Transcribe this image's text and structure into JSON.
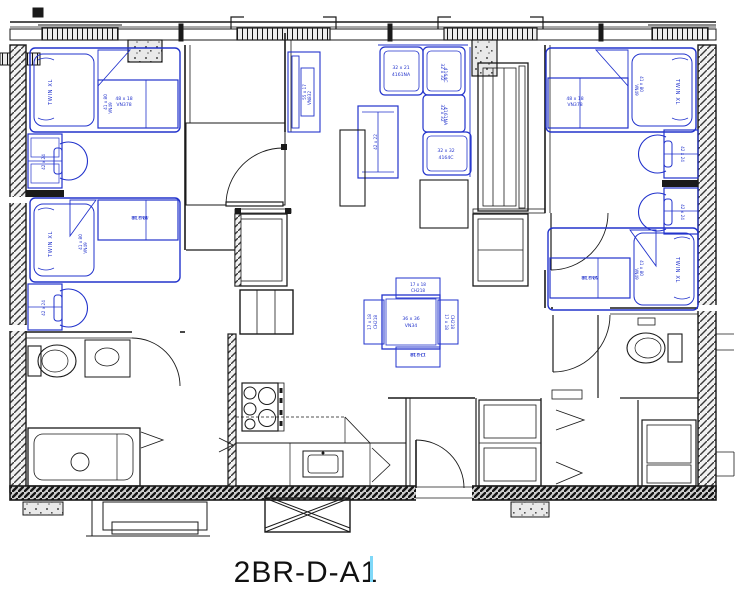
{
  "plan": {
    "title": "2BR-D-A1"
  },
  "furniture": {
    "bed": {
      "name": "TWIN XL",
      "dim": "41 x 80",
      "sku": "VN49"
    },
    "chest": {
      "dim": "48 x 18",
      "sku": "VN378"
    },
    "desk": {
      "dim": "42 x 24"
    },
    "tv_console": {
      "dim": "55 x 17",
      "sku": "VN832"
    },
    "coffee_table": {
      "dim": "42 x 22"
    },
    "dining_table": {
      "dim": "36 x 36",
      "sku": "VN34"
    },
    "dining_chair": {
      "dim": "17 x 18",
      "sku": "CH218"
    },
    "sofa_corner": {
      "dim": "32 x 21",
      "sku": "4161NA"
    },
    "sofa_seat1": {
      "dim": "32 x 32",
      "sku": "4164C"
    },
    "sofa_seat2": {
      "dim": "32 x 32",
      "sku": "4161NA"
    },
    "sofa_seat3": {
      "dim": "32 x 32",
      "sku": "4164C"
    }
  },
  "colors": {
    "furniture_blue": "#2233cc",
    "wall_black": "#1a1a1a",
    "caret_cyan": "#7fd8f8"
  }
}
